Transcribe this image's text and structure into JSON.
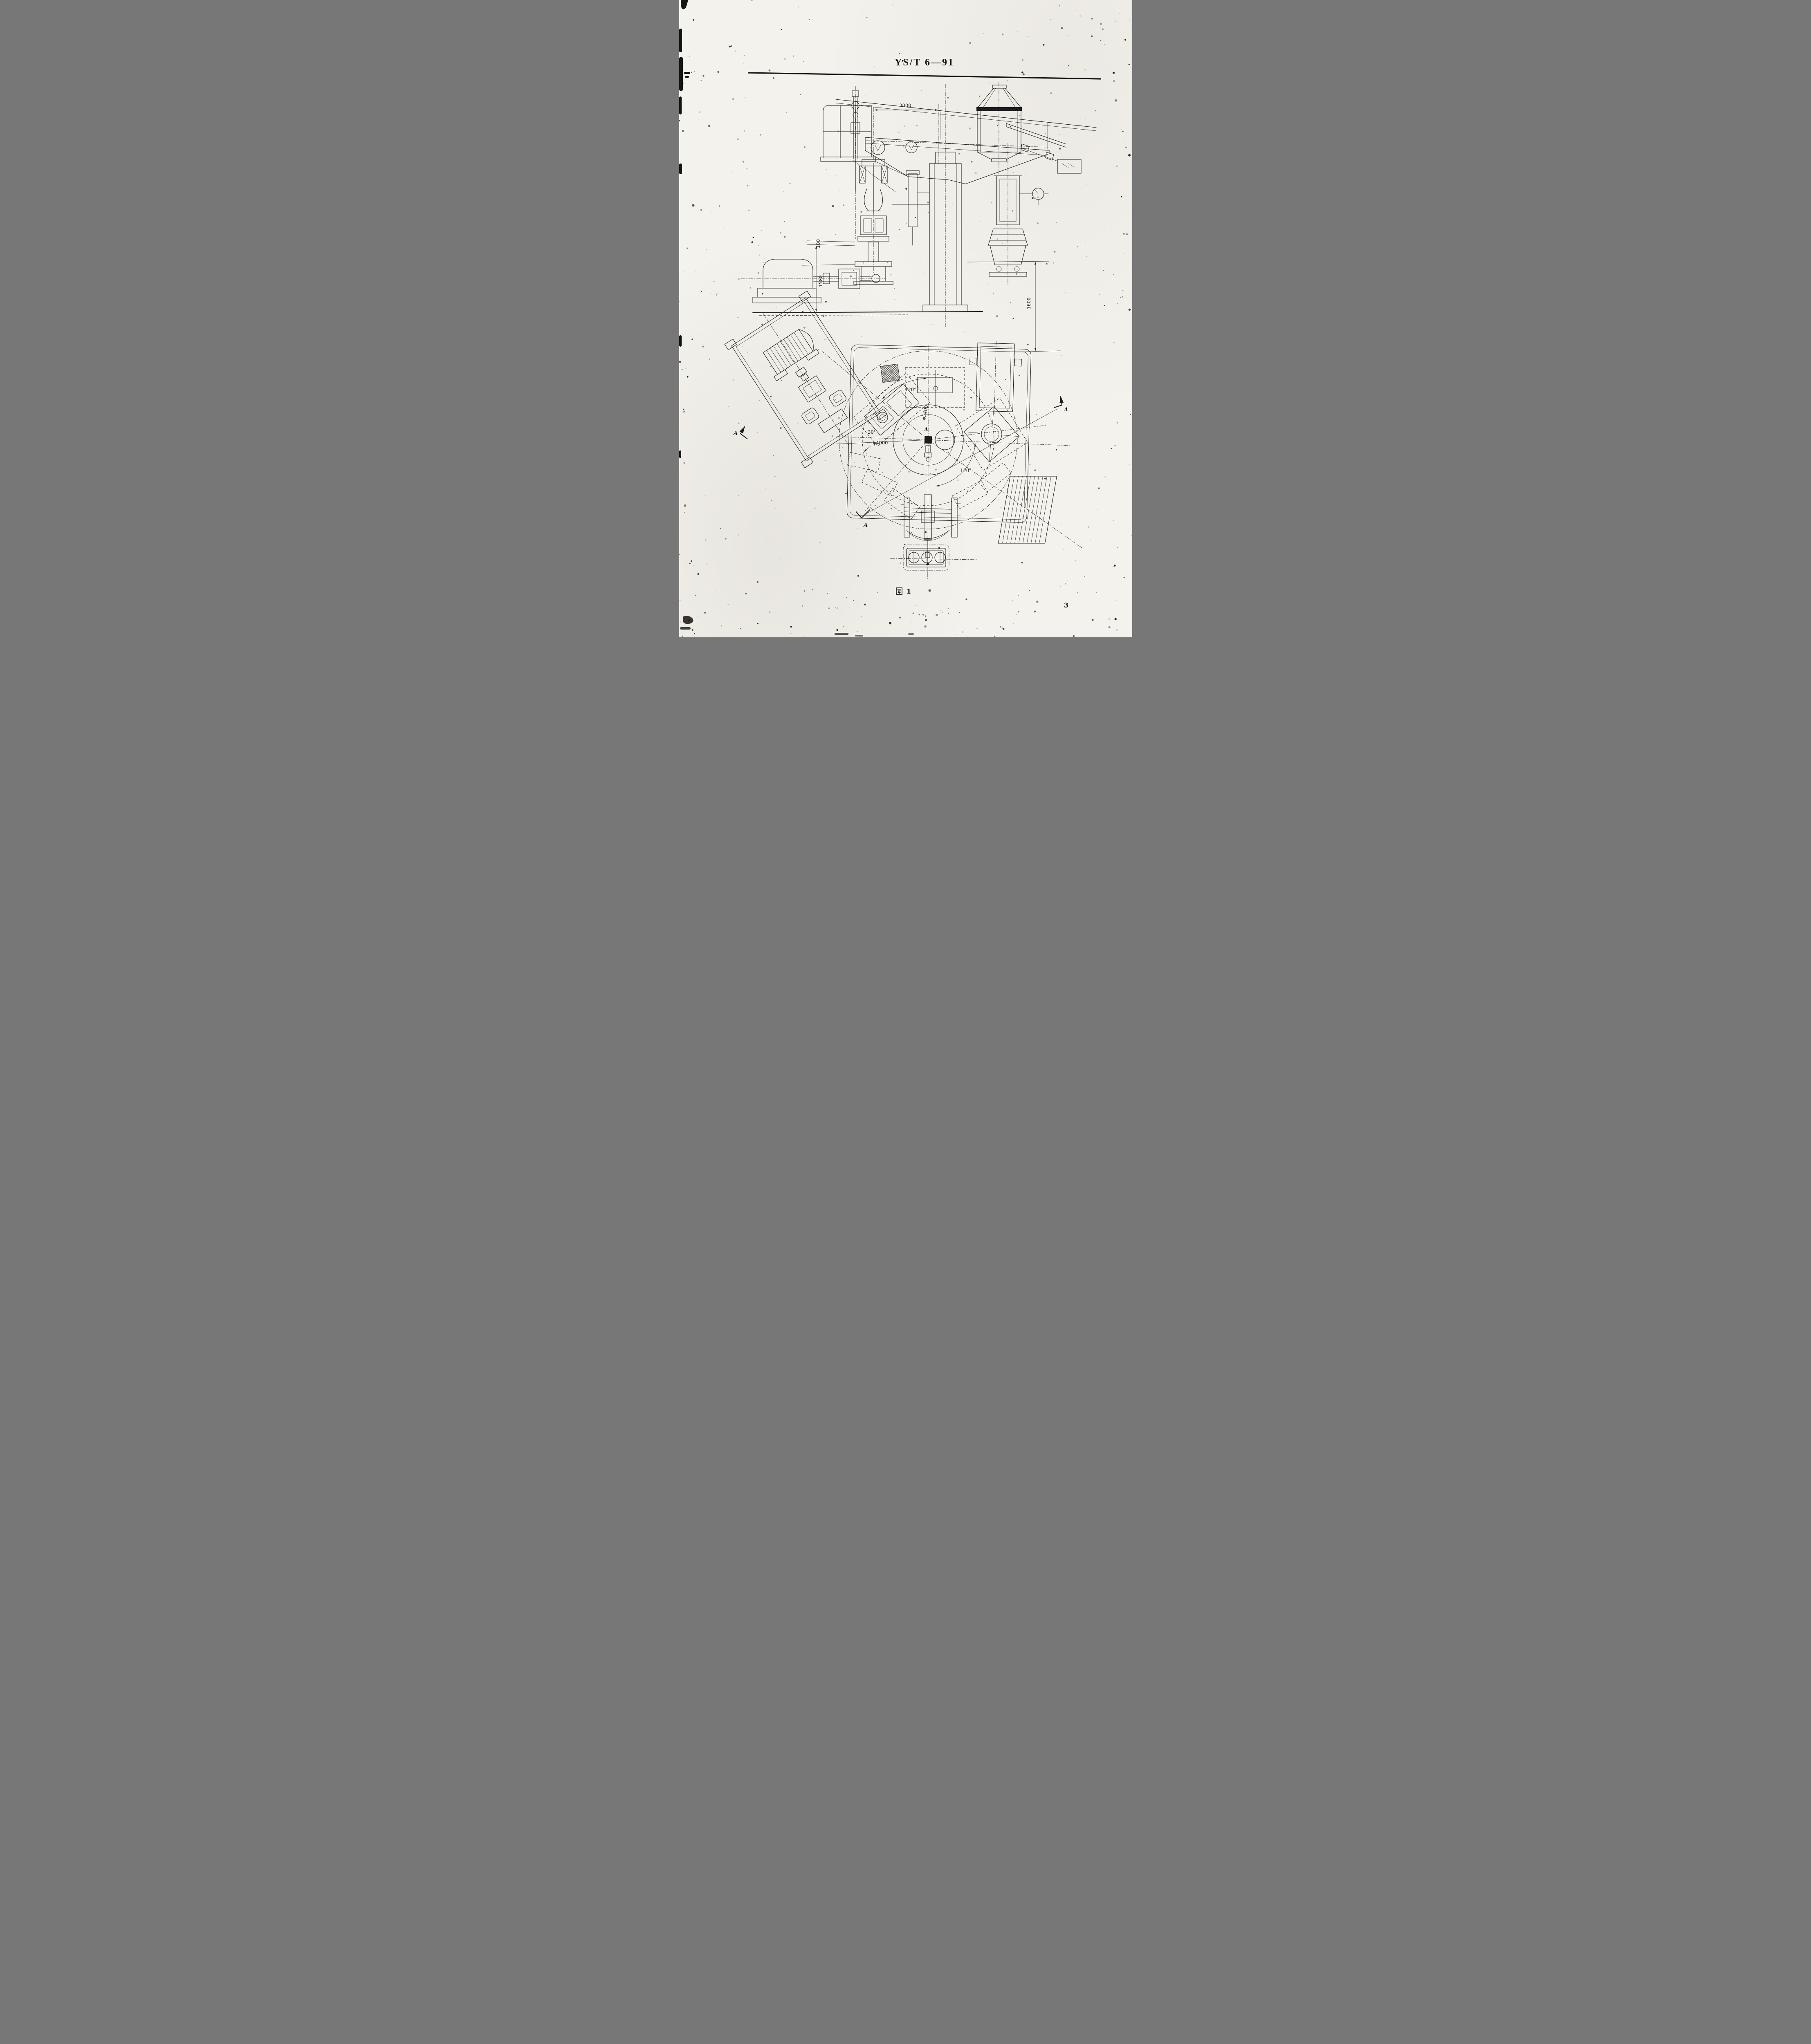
{
  "page": {
    "standard_code": "YS/T 6—91",
    "page_number": "3",
    "figure_caption": {
      "hanzi": "图",
      "number": "1",
      "label": "图 1"
    }
  },
  "front_view": {
    "dimensions": {
      "top_width": "2000",
      "left_small": "100",
      "left_height": "1580",
      "right_height": "1600"
    }
  },
  "plan_view": {
    "dimensions": {
      "outer_circle": "φ5400",
      "inner_circle": "φ4000",
      "angle_top": "120°",
      "angle_bottom": "120°",
      "angle_offset": "30'"
    },
    "section_label": "A",
    "center_label": "A"
  }
}
